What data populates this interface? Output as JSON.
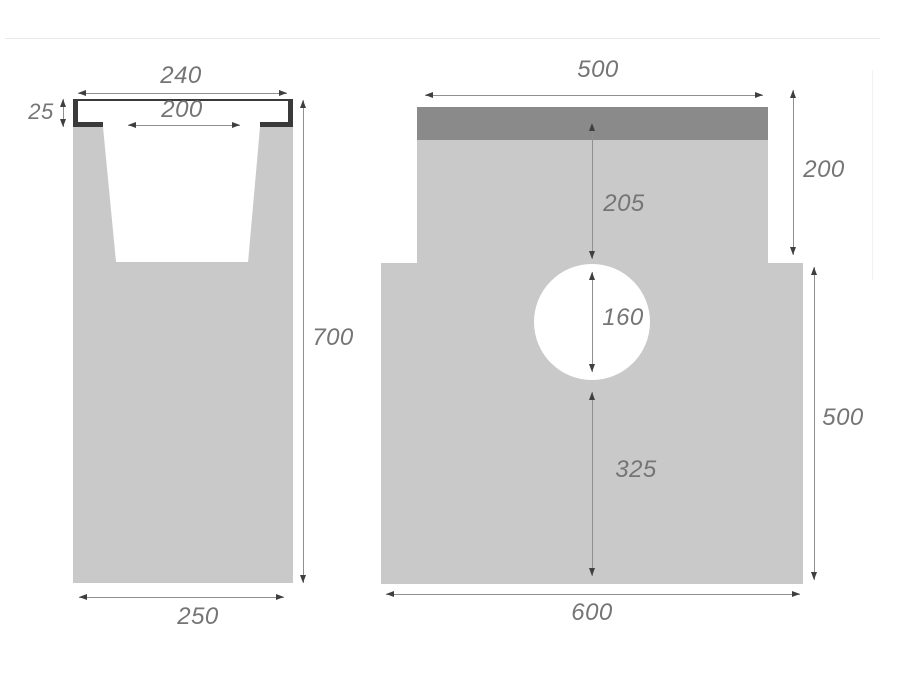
{
  "diagram": {
    "type": "technical-drawing",
    "subject": "concrete drainage channel cross-section and front view",
    "units_shown": false,
    "colors": {
      "body_gray": "#c9c9c9",
      "grate_band_gray": "#8a8a8a",
      "edge_rail_dark": "#3a3a3a",
      "dim_line": "#909090",
      "arrow": "#3f3f3f",
      "label_text": "#757575",
      "background": "#ffffff"
    },
    "left_view": {
      "name": "channel cross-section",
      "dims": {
        "top_width": "240",
        "opening_width": "200",
        "edge_rail_height": "25",
        "overall_height": "700",
        "base_width": "250"
      }
    },
    "right_view": {
      "name": "channel front view",
      "dims": {
        "top_width": "500",
        "upper_section_height": "200",
        "top_to_outlet": "205",
        "outlet_diameter": "160",
        "outlet_to_base": "325",
        "lower_section_height": "500",
        "base_width": "600"
      }
    }
  }
}
